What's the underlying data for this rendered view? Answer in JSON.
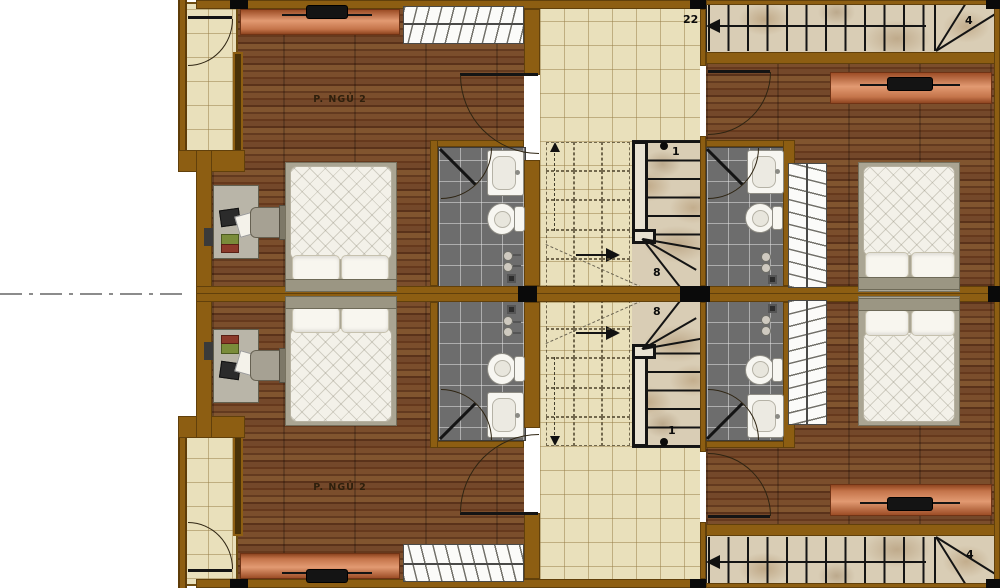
{
  "labels": {
    "bedroom_top": "P. NGỦ 2",
    "bedroom_bottom": "P. NGỦ 2",
    "stair_top_right_start": "22",
    "stair_top_right_end": "4",
    "stair_bottom_right_end": "4",
    "stair_center_top_first": "1",
    "stair_center_top_winder": "8",
    "stair_center_bottom_winder": "8",
    "stair_center_bottom_first": "1"
  },
  "colors": {
    "wall": "#8d5e12",
    "wood": "#6e4426",
    "tile": "#e9e0bb",
    "bath-tile": "#6d6d6d",
    "marble": "#d9cdb5",
    "ink": "#141414",
    "label": "#2e1f0c"
  }
}
